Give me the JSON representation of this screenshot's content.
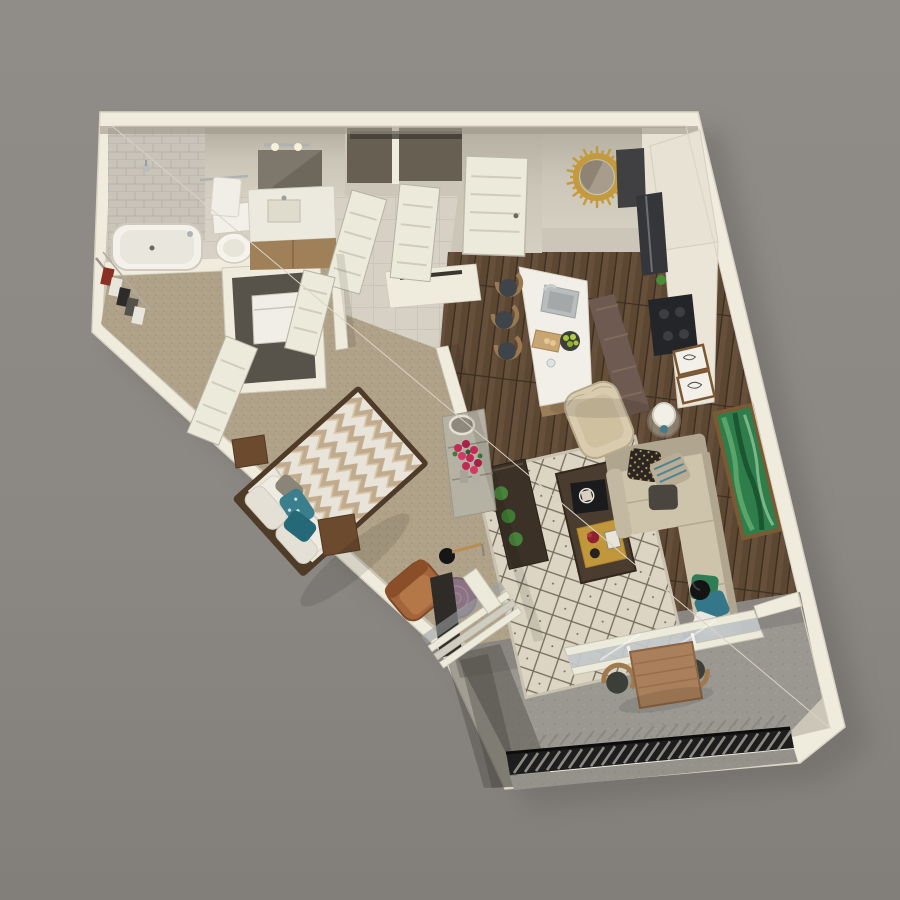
{
  "scene": {
    "title": "3d-floorplan-render-one-bedroom-apartment",
    "view": "top-down dollhouse 3D render, unit rotated, gray studio background",
    "rooms": [
      {
        "id": "bathroom",
        "name": "bathroom",
        "floor": "light-tile",
        "items": [
          "tiled-shower-wall",
          "bathtub",
          "shower-head",
          "toilet",
          "towel-bar-with-towel",
          "vanity-sink",
          "mirror",
          "vanity-light"
        ]
      },
      {
        "id": "walk-in-closet",
        "name": "walk-in closet",
        "floor": "carpet",
        "items": [
          "wire-shelving",
          "hanging-clothes"
        ]
      },
      {
        "id": "laundry-closet",
        "name": "laundry closet",
        "floor": "carpet",
        "items": [
          "washer",
          "bifold-doors"
        ]
      },
      {
        "id": "entry",
        "name": "entry hall",
        "floor": "tile-to-wood",
        "items": [
          "entry-door",
          "two-hall-closets-open-doors",
          "sunburst-mirror"
        ]
      },
      {
        "id": "kitchen",
        "name": "kitchen",
        "floor": "wood-plank",
        "items": [
          "island-with-sink",
          "faucet",
          "cutting-board",
          "bowl-of-limes",
          "3-bar-stools",
          "refrigerator",
          "upper-cabinet",
          "cooktop",
          "counter-run",
          "runner-rug",
          "2-framed-sketches",
          "small-plant"
        ]
      },
      {
        "id": "living",
        "name": "living room",
        "floor": "wood-plank",
        "items": [
          "l-shaped-beige-sofa",
          "6-accent-pillows",
          "diamond-pattern-rug",
          "coffee-table-with-book-and-tray",
          "media-console",
          "3-green-topiaries",
          "cream-wingback-chair",
          "glass-side-table",
          "white-table-lamp",
          "black-floor-lamp",
          "green-abstract-art",
          "sliding-glass-door"
        ]
      },
      {
        "id": "bedroom",
        "name": "bedroom",
        "floor": "carpet",
        "items": [
          "bed-chevron-duvet",
          "teal-accent-pillows",
          "2-wood-nightstands",
          "open-shelf-console",
          "rose-bouquets",
          "round-stand-mirror",
          "leather-armchair",
          "round-purple-side-table",
          "arc-floor-lamp",
          "sliding-glass-door"
        ]
      },
      {
        "id": "balcony",
        "name": "balcony",
        "floor": "concrete",
        "items": [
          "metal-slat-railing",
          "wood-dining-table",
          "2-curved-dining-chairs"
        ]
      }
    ],
    "counts": {
      "bar_stools": 3,
      "dining_chairs": 2,
      "sofa_pillows": 6,
      "topiaries": 3,
      "framed_sketches": 2
    },
    "pillow_colors": [
      "#2b2623",
      "#b9ae95",
      "#4a463f",
      "#2f7d57",
      "#35778a",
      "#e9e7e0"
    ]
  },
  "palette": {
    "bg": "#8b8783",
    "bgDark": "#7e7a76",
    "shadow": "#66635f",
    "wall": "#efebdd",
    "wallShade": "#ddd8c9",
    "wallFace": "#cbc6b7",
    "closetDark": "#675f52",
    "tile": "#d6d1c4",
    "tileLine": "#c0bbae",
    "shower": "#c9c4ba",
    "carpet": "#b0a289",
    "wood": "#5c4733",
    "woodDark": "#47362a",
    "concrete": "#9b9892",
    "concreteDark": "#716e69",
    "railing": "#1d1d1d",
    "rug": "#dcd5c4",
    "rugLine": "#756c5c",
    "runner": "#6e5a50",
    "sofa": "#cec3ab",
    "sofaShade": "#b0a58e",
    "chairCream": "#d8cbae",
    "leather": "#a4653c",
    "tablePurple": "#8b7383",
    "coffee": "#4a3d30",
    "console": "#3b3126",
    "gold": "#c49a3f",
    "artGreen": "#2e7d4b",
    "teal": "#35778a",
    "duvet": "#e9e4da",
    "chevron": "#c1ab8e",
    "nightstand": "#6b4a2e",
    "dresser": "#b6b2a3",
    "flower": "#c12a56",
    "leaf": "#3f7a3a",
    "island": "#f1efe7",
    "counter": "#e7e2d3",
    "steel": "#b9bdbe",
    "doorWhite": "#eceada",
    "glass": "#c2c8ca",
    "dark": "#232325",
    "tray": "#c1973c",
    "lime": "#a8c23a",
    "dineWood": "#a9805b"
  }
}
